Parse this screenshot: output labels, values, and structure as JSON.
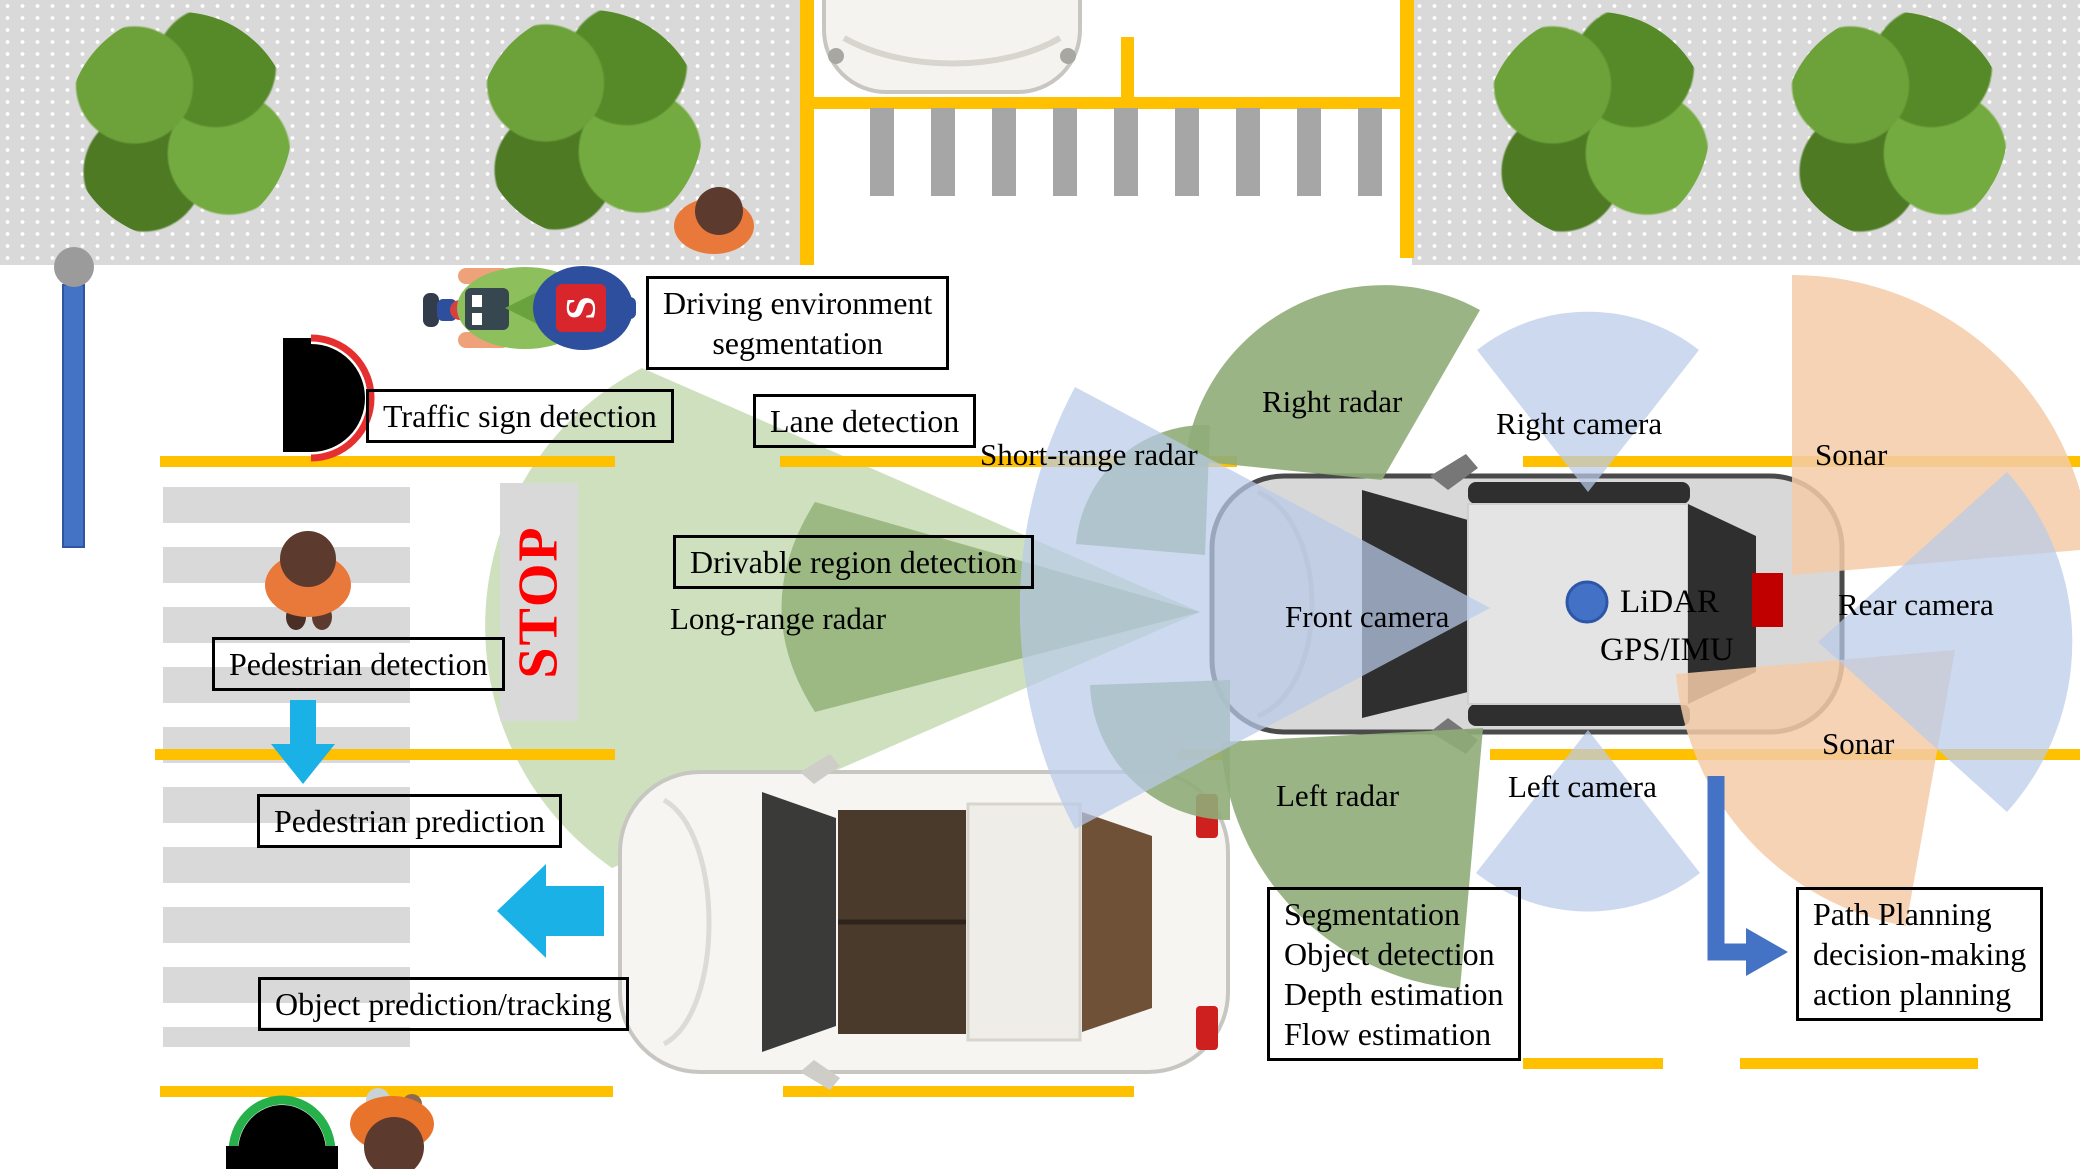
{
  "scene": {
    "stop_text": "STOP",
    "delivery_badge": "S"
  },
  "boxes": {
    "driving_env_segmentation": "Driving environment\nsegmentation",
    "traffic_sign_detection": "Traffic sign detection",
    "lane_detection": "Lane detection",
    "drivable_region_detection": "Drivable region detection",
    "pedestrian_detection": "Pedestrian detection",
    "pedestrian_prediction": "Pedestrian prediction",
    "object_prediction_tracking": "Object prediction/tracking",
    "perception_outputs": "Segmentation\nObject detection\nDepth estimation\nFlow estimation",
    "path_planning": "Path Planning\ndecision-making\naction planning"
  },
  "sensor_labels": {
    "short_range_radar": "Short-range radar",
    "long_range_radar": "Long-range radar",
    "right_radar": "Right radar",
    "right_camera": "Right camera",
    "front_camera": "Front camera",
    "left_radar": "Left radar",
    "left_camera": "Left camera",
    "rear_camera": "Rear camera",
    "sonar_top": "Sonar",
    "sonar_bottom": "Sonar",
    "lidar": "LiDAR",
    "gps_imu": "GPS/IMU"
  },
  "colors": {
    "lane_yellow": "#FFC000",
    "radar_green": "#8fac79",
    "radar_light_green": "#cbdeb9",
    "camera_blue": "#b9cbe9",
    "sonar_orange": "#f4cba8",
    "cyan_arrow": "#19b1e6",
    "flow_blue": "#4472c4",
    "stop_red": "#ff0000",
    "sidewalk_gray": "#d9d9d9"
  }
}
